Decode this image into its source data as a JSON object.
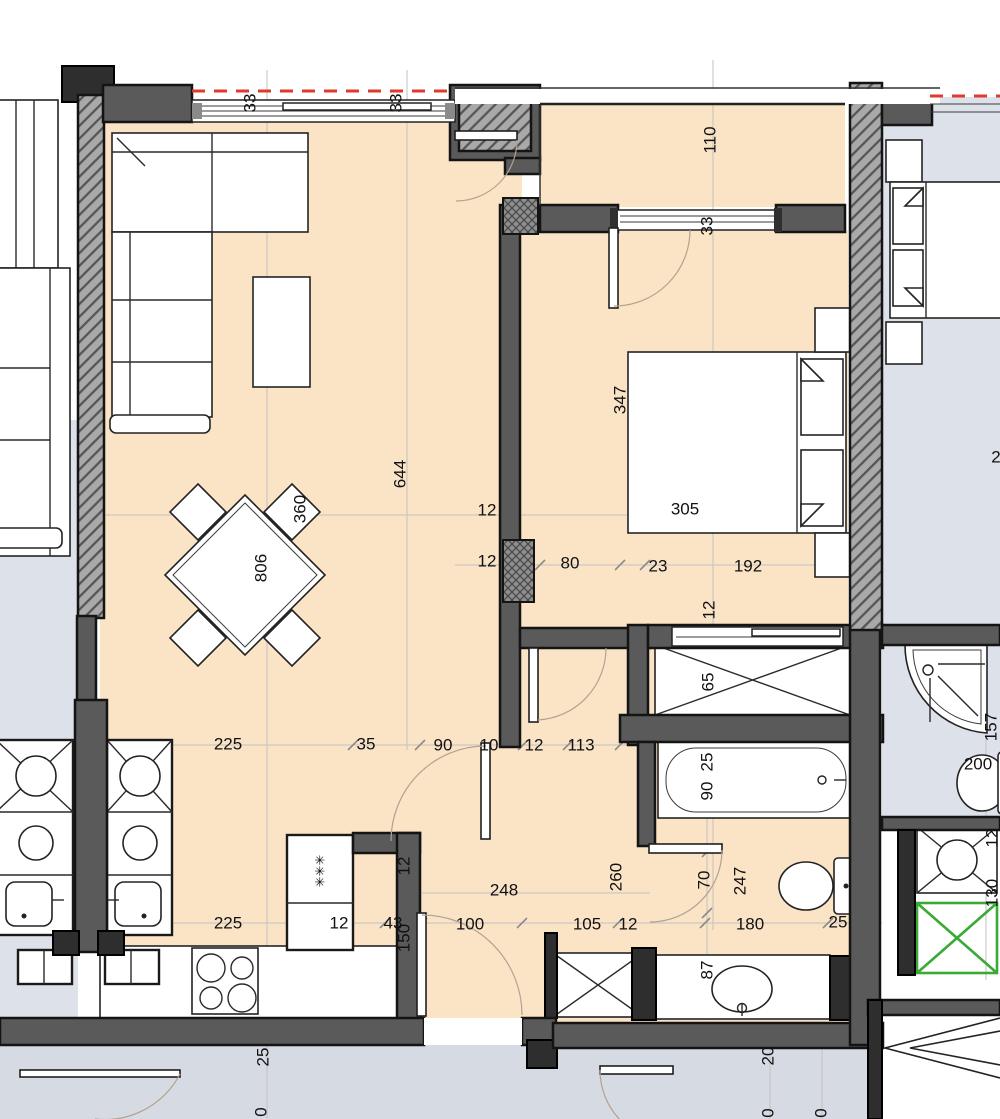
{
  "document": {
    "kind": "apartment-floor-plan",
    "units": "centimeters-implied"
  },
  "palette": {
    "floorA": "#fbe3c6",
    "floorN": "#dde1ea",
    "floorC": "#d6dae3",
    "wall": "#5a5a5a",
    "wallDark": "#2e2e2e",
    "red": "#e0392e",
    "green": "#3aaa35",
    "grid": "#c2c2c2"
  },
  "elements": [
    "corner-sofa",
    "coffee-table",
    "dining-table",
    "dining-chairs",
    "kitchen-sink-unit",
    "neighbor-sink-unit",
    "stove",
    "tall-appliance",
    "double-bed",
    "nightstands",
    "wardrobe-shaft",
    "bathtub",
    "toilet",
    "wash-basin",
    "shower-tray",
    "elevator-shaft",
    "staircase",
    "entrance-door",
    "balcony-door",
    "interior-doors",
    "windows",
    "party-walls"
  ],
  "labels": [
    {
      "t": "33",
      "x": 250,
      "y": 103,
      "r": 90
    },
    {
      "t": "33",
      "x": 396,
      "y": 103,
      "r": 90
    },
    {
      "t": "110",
      "x": 710,
      "y": 140,
      "r": 90
    },
    {
      "t": "33",
      "x": 707,
      "y": 226,
      "r": 90
    },
    {
      "t": "347",
      "x": 620,
      "y": 400,
      "r": 90
    },
    {
      "t": "305",
      "x": 685,
      "y": 509,
      "r": 0
    },
    {
      "t": "644",
      "x": 400,
      "y": 474,
      "r": 90
    },
    {
      "t": "360",
      "x": 300,
      "y": 509,
      "r": 90
    },
    {
      "t": "806",
      "x": 261,
      "y": 568,
      "r": 90
    },
    {
      "t": "12",
      "x": 487,
      "y": 510,
      "r": 0
    },
    {
      "t": "12",
      "x": 487,
      "y": 561,
      "r": 0
    },
    {
      "t": "80",
      "x": 570,
      "y": 563,
      "r": 0
    },
    {
      "t": "23",
      "x": 658,
      "y": 566,
      "r": 0
    },
    {
      "t": "192",
      "x": 748,
      "y": 566,
      "r": 0
    },
    {
      "t": "12",
      "x": 709,
      "y": 610,
      "r": 90
    },
    {
      "t": "225",
      "x": 228,
      "y": 744,
      "r": 0
    },
    {
      "t": "35",
      "x": 366,
      "y": 744,
      "r": 0
    },
    {
      "t": "90",
      "x": 443,
      "y": 745,
      "r": 0
    },
    {
      "t": "10",
      "x": 489,
      "y": 745,
      "r": 0
    },
    {
      "t": "12",
      "x": 534,
      "y": 745,
      "r": 0
    },
    {
      "t": "113",
      "x": 581,
      "y": 745,
      "r": 0
    },
    {
      "t": "65",
      "x": 708,
      "y": 682,
      "r": 90
    },
    {
      "t": "25",
      "x": 707,
      "y": 762,
      "r": 90
    },
    {
      "t": "90",
      "x": 707,
      "y": 791,
      "r": 90
    },
    {
      "t": "157",
      "x": 991,
      "y": 727,
      "r": 90
    },
    {
      "t": "200",
      "x": 978,
      "y": 764,
      "r": 0
    },
    {
      "t": "12",
      "x": 992,
      "y": 838,
      "r": 90
    },
    {
      "t": "130",
      "x": 992,
      "y": 893,
      "r": 90
    },
    {
      "t": "225",
      "x": 228,
      "y": 923,
      "r": 0
    },
    {
      "t": "12",
      "x": 339,
      "y": 923,
      "r": 0
    },
    {
      "t": "43",
      "x": 393,
      "y": 923,
      "r": 0
    },
    {
      "t": "150",
      "x": 404,
      "y": 938,
      "r": 90
    },
    {
      "t": "100",
      "x": 470,
      "y": 924,
      "r": 0
    },
    {
      "t": "105",
      "x": 587,
      "y": 924,
      "r": 0
    },
    {
      "t": "12",
      "x": 628,
      "y": 924,
      "r": 0
    },
    {
      "t": "180",
      "x": 750,
      "y": 924,
      "r": 0
    },
    {
      "t": "25",
      "x": 838,
      "y": 922,
      "r": 0
    },
    {
      "t": "248",
      "x": 504,
      "y": 890,
      "r": 0
    },
    {
      "t": "260",
      "x": 616,
      "y": 877,
      "r": 90
    },
    {
      "t": "12",
      "x": 404,
      "y": 866,
      "r": 90
    },
    {
      "t": "70",
      "x": 704,
      "y": 880,
      "r": 90
    },
    {
      "t": "247",
      "x": 740,
      "y": 881,
      "r": 90
    },
    {
      "t": "87",
      "x": 707,
      "y": 970,
      "r": 90
    },
    {
      "t": "25",
      "x": 263,
      "y": 1057,
      "r": 90
    },
    {
      "t": "20",
      "x": 768,
      "y": 1056,
      "r": 90
    },
    {
      "t": "0",
      "x": 261,
      "y": 1112,
      "r": 90
    },
    {
      "t": "0",
      "x": 768,
      "y": 1113,
      "r": 90
    },
    {
      "t": "0",
      "x": 821,
      "y": 1113,
      "r": 90
    },
    {
      "t": "2",
      "x": 996,
      "y": 457,
      "r": 0
    },
    {
      "t": "✳✳✳",
      "x": 320,
      "y": 871,
      "r": 90,
      "s": 13
    }
  ]
}
